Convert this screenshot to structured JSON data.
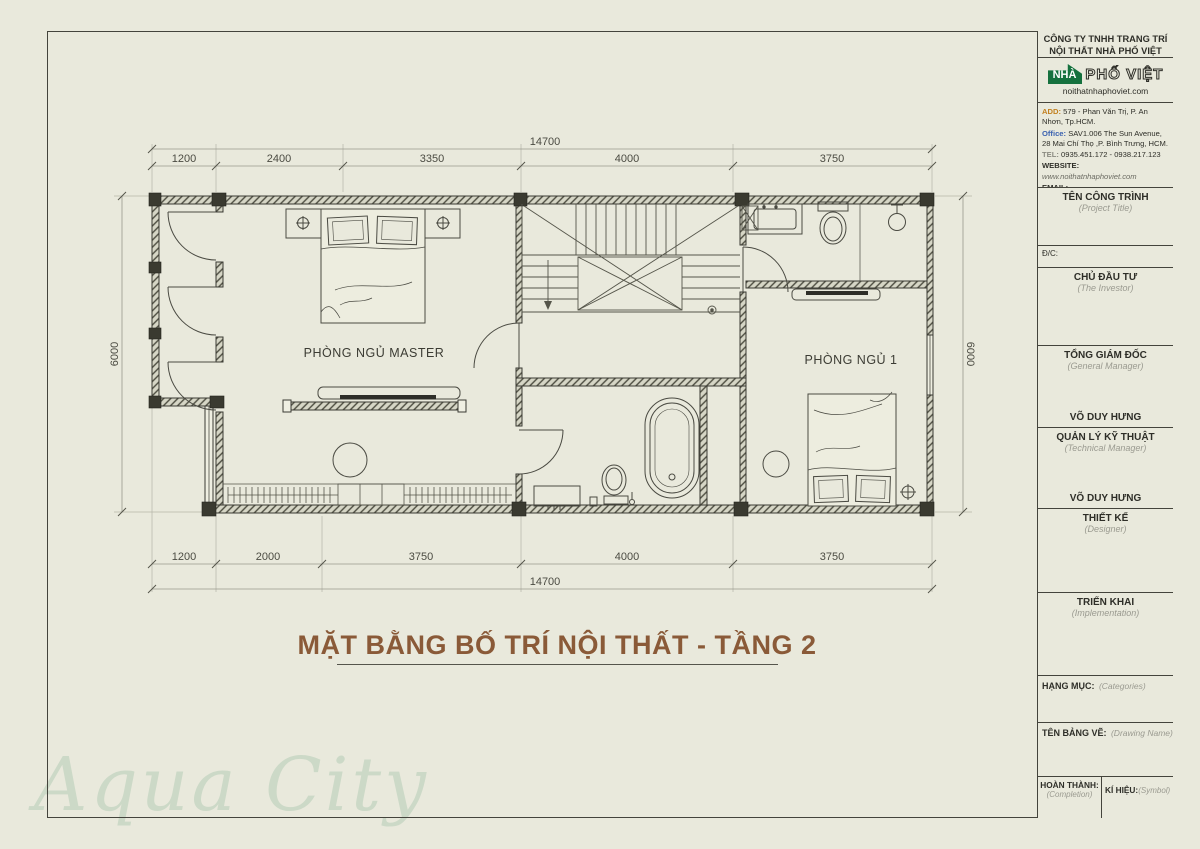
{
  "page": {
    "background": "#e9e9dc",
    "frame_color": "#44443c"
  },
  "watermark": {
    "text": "Aqua City",
    "color": "#ccd9c7"
  },
  "plan": {
    "title": "MẶT BẰNG BỐ TRÍ NỘI THẤT - TẦNG 2",
    "title_color": "#8a5a38",
    "rooms": {
      "master": "PHÒNG NGỦ MASTER",
      "bedroom1": "PHÒNG NGỦ 1"
    },
    "dimensions": {
      "top_total": "14700",
      "top_segments": [
        "1200",
        "2400",
        "3350",
        "4000",
        "3750"
      ],
      "bottom_segments": [
        "1200",
        "2000",
        "3750",
        "4000",
        "3750"
      ],
      "bottom_total": "14700",
      "left_height": "6000",
      "right_height": "6000"
    }
  },
  "title_block": {
    "company_line1": "CÔNG TY TNHH TRANG TRÍ",
    "company_line2": "NỘI THẤT NHÀ PHỐ VIỆT",
    "logo": {
      "house_text": "NHÀ",
      "brand_text": "PHỐ VIỆT",
      "website": "noithatnhaphoviet.com",
      "green": "#15713e"
    },
    "contact": {
      "add_label": "ADD:",
      "add_value": "579 - Phan Văn Trị, P. An Nhơn, Tp.HCM.",
      "office_label": "Office:",
      "office_value": "SAV1.006 The Sun Avenue, 28 Mai Chí Thọ ,P. Bình Trưng, HCM.",
      "tel_label": "TEL:",
      "tel_value": "0935.451.172 - 0938.217.123",
      "website_label": "WEBSITE:",
      "website_value": "www.noithatnhaphoviet.com",
      "email_label": "EMAIL:",
      "email_value": "nhaphoviettphcm@gmail.com"
    },
    "sections": {
      "project_title": {
        "vn": "TÊN CÔNG TRÌNH",
        "en": "(Project Title)"
      },
      "address_label": "Đ/C:",
      "investor": {
        "vn": "CHỦ ĐẦU TƯ",
        "en": "(The Investor)"
      },
      "gm": {
        "vn": "TỔNG GIÁM ĐỐC",
        "en": "(General Manager)",
        "name": "VÕ DUY HƯNG"
      },
      "tech": {
        "vn": "QUẢN LÝ KỸ THUẬT",
        "en": "(Technical Manager)",
        "name": "VÕ DUY HƯNG"
      },
      "designer": {
        "vn": "THIẾT KẾ",
        "en": "(Designer)"
      },
      "implementation": {
        "vn": "TRIỂN KHAI",
        "en": "(Implementation)"
      },
      "categories": {
        "vn": "HẠNG MỤC:",
        "en": "(Categories)"
      },
      "drawing_name": {
        "vn": "TÊN BẢNG VẼ:",
        "en": "(Drawing Name)"
      },
      "completion": {
        "vn": "HOÀN THÀNH:",
        "en": "(Completion)"
      },
      "symbol": {
        "vn": "KÍ HIỆU:",
        "en": "(Symbol)"
      }
    }
  }
}
